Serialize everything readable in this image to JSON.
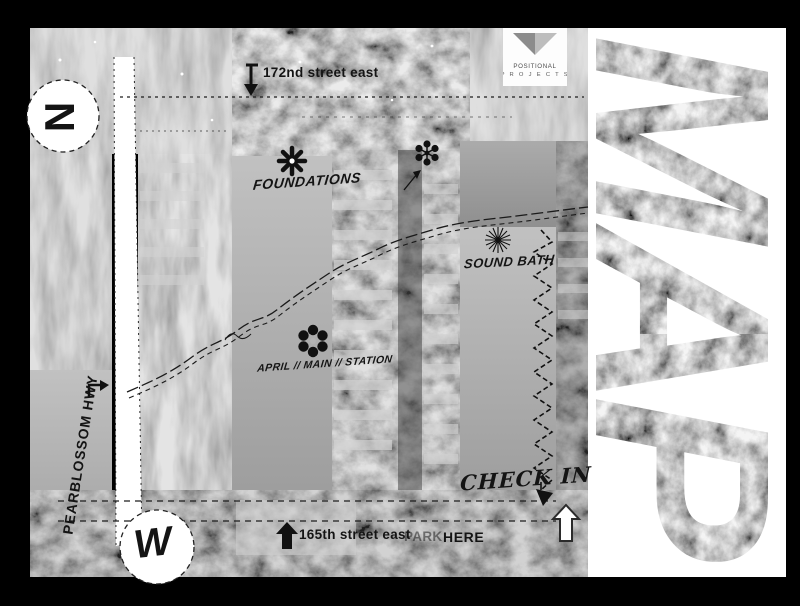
{
  "poster": {
    "title_word": {
      "letters": [
        "M",
        "A",
        "P"
      ]
    },
    "logo": {
      "line1": "POSITIONAL",
      "line2": "P R O J E C T S"
    },
    "compass": {
      "north": "N",
      "west": "W"
    },
    "roads": {
      "top_street": "172nd street east",
      "bottom_street": "165th street east",
      "park_text": "PARK",
      "here_text": "HERE",
      "highway": "PEARBLOSSOM HWY"
    },
    "stations": {
      "foundations": "FOUNDATIONS",
      "mid_station": "APRIL // MAIN // STATION",
      "sound_bath": "SOUND BATH",
      "check_in": "CHECK IN"
    },
    "colors": {
      "ink": "#1a1a1a",
      "paper": "#ffffff",
      "frame": "#000000"
    }
  }
}
